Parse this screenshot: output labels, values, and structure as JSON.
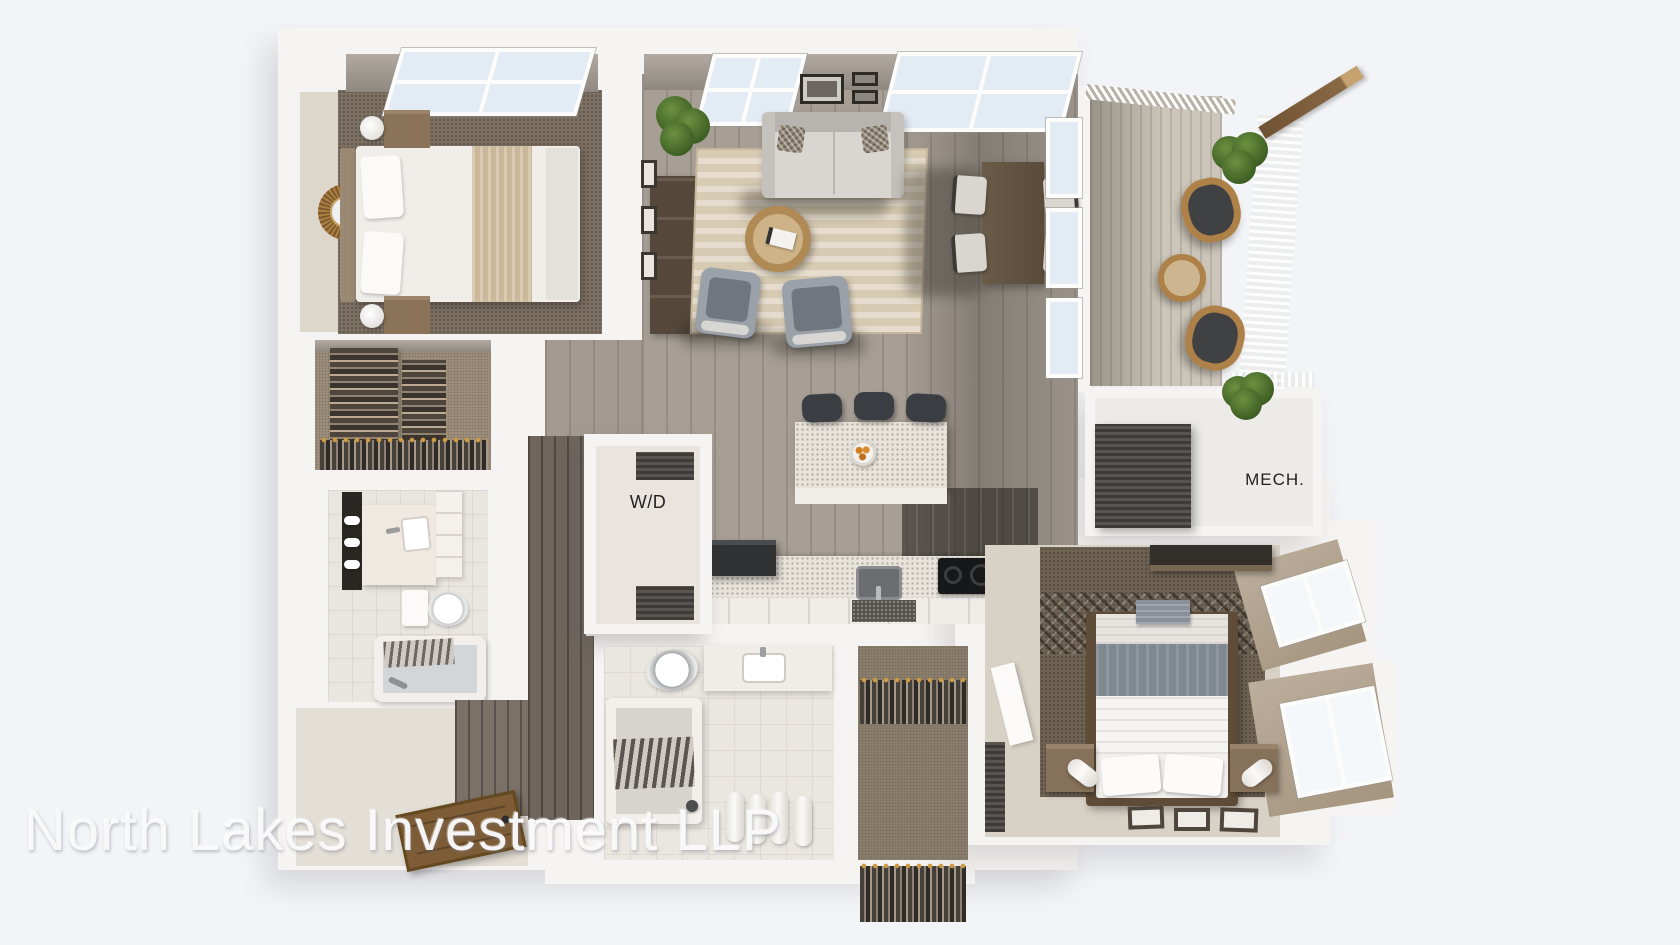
{
  "page": {
    "background": "#f3f4f7"
  },
  "watermark": {
    "text": "North Lakes Investment LLP"
  },
  "plan": {
    "labels": {
      "washer_dryer": "W/D",
      "mechanical": "MECH."
    },
    "palette": {
      "wall": "#f6f4f2",
      "interior_wall_shade": "#a89f96",
      "wood_floor": "#a79f95",
      "dark_wood_floor": "#6e655c",
      "carpet_dark": "#7a6e60",
      "carpet_tan": "#a2937f",
      "rug": "#d8cbb3",
      "deck": "#ccc5b9",
      "counter": "#e8e3db",
      "appliance_dark": "#2f3134",
      "wicker": "#ae8148",
      "plant": "#4d7031",
      "door_wood": "#7d5c36",
      "label_text": "#222222",
      "watermark_text": "#fbfbfd"
    }
  }
}
